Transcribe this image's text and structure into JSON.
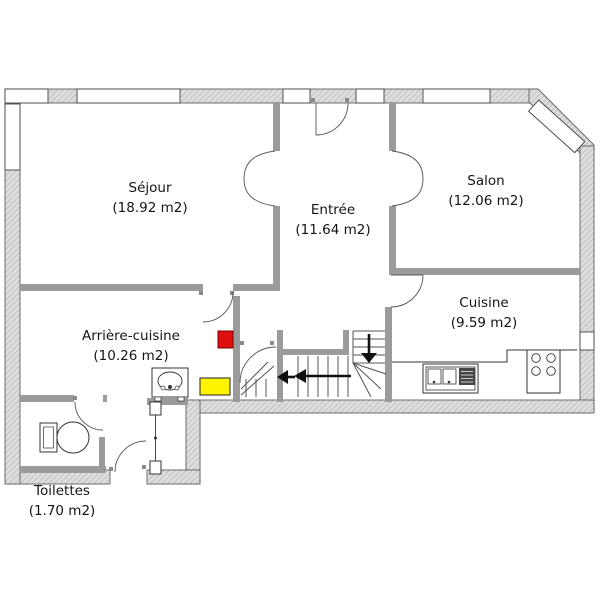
{
  "rooms": {
    "sejour": {
      "name": "Séjour",
      "area": "(18.92 m2)"
    },
    "entree": {
      "name": "Entrée",
      "area": "(11.64 m2)"
    },
    "salon": {
      "name": "Salon",
      "area": "(12.06 m2)"
    },
    "cuisine": {
      "name": "Cuisine",
      "area": "(9.59 m2)"
    },
    "arriere": {
      "name": "Arrière-cuisine",
      "area": "(10.26 m2)"
    },
    "toilettes": {
      "name": "Toilettes",
      "area": "(1.70 m2)"
    }
  },
  "colors": {
    "marker_red": "#e01010",
    "marker_yellow": "#fff500",
    "interior_wall": "#9b9b9b",
    "outer_wall_line": "#606060"
  }
}
